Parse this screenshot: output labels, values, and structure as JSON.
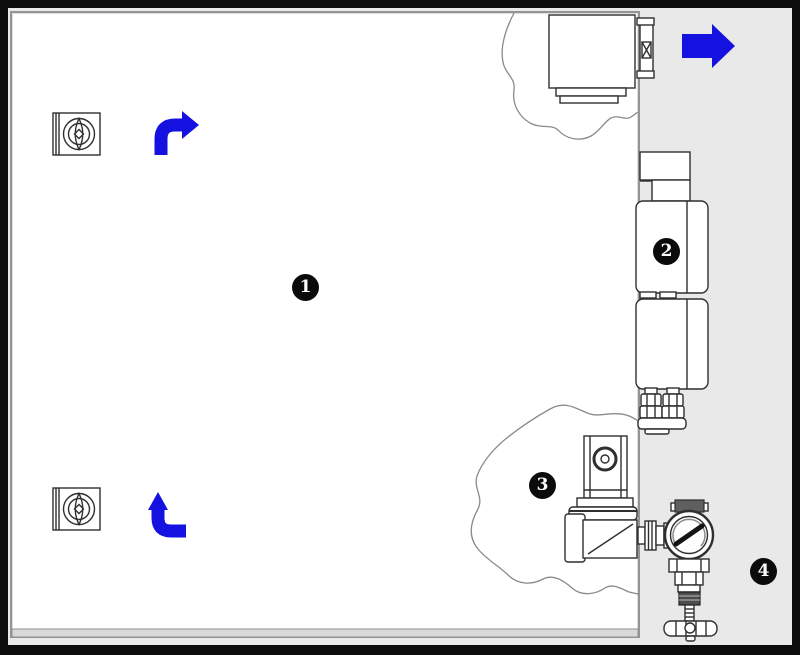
{
  "figure": {
    "kind": "equipment-line-diagram"
  },
  "callouts": [
    {
      "number": "1"
    },
    {
      "number": "2"
    },
    {
      "number": "3"
    },
    {
      "number": "4"
    }
  ],
  "icons": {
    "arrow_top_left": "curved-arrow-right-icon",
    "arrow_bottom_left": "curved-arrow-up-icon",
    "arrow_outlet": "arrow-right-icon",
    "nozzle": "nozzle-swirl-icon",
    "exhaust": "exhaust-box",
    "filter_block": "filter-block",
    "solenoid_valve": "solenoid-valve",
    "regulator": "pressure-regulator-gauge",
    "knob": "hand-knob"
  },
  "colors": {
    "arrow_blue": "#1511e0",
    "background_gray": "#e9e9e9",
    "chamber_white": "#ffffff",
    "wall_gray": "#949494",
    "line_art": "#2f2f2f",
    "cloud_gray": "#8a8a8a",
    "border_black": "#0c0c0c",
    "badge_bg": "#0b0b0b",
    "badge_text": "#ffffff"
  }
}
